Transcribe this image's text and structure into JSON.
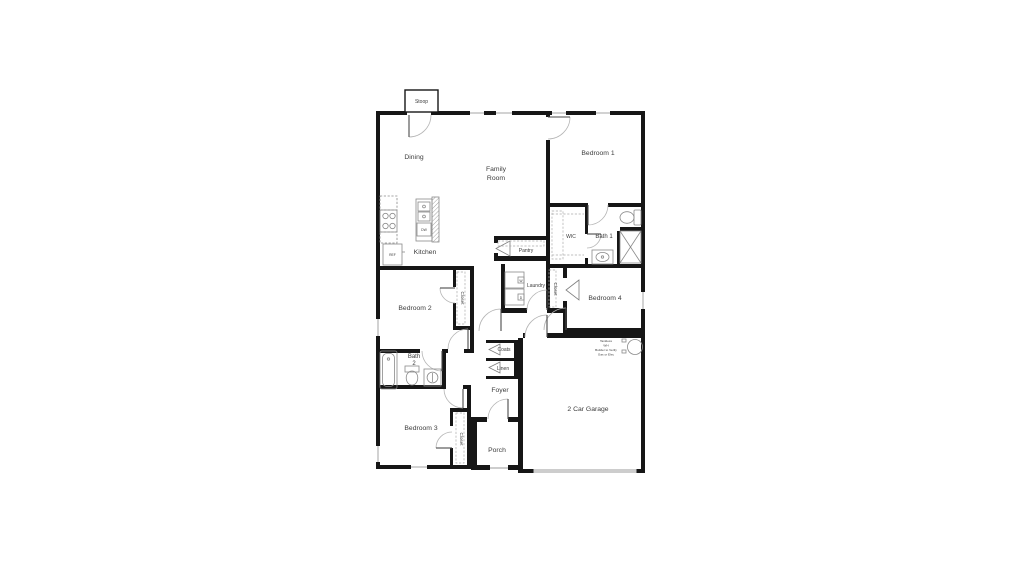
{
  "plan_title": "Single-story residential floor plan",
  "rooms": {
    "stoop": "Stoop",
    "dining": "Dining",
    "family_line1": "Family",
    "family_line2": "Room",
    "bedroom1": "Bedroom 1",
    "kitchen": "Kitchen",
    "wic": "WIC",
    "bath1": "Bath 1",
    "pantry": "Pantry",
    "laundry": "Laundry",
    "bedroom2": "Bedroom 2",
    "bedroom4": "Bedroom 4",
    "closet_bedroom2": "Closet",
    "closet_bedroom3": "Closet",
    "closet_bedroom4": "Closet",
    "coats": "Coats",
    "linen": "Linen",
    "bath2_line1": "Bath",
    "bath2_line2": "2",
    "foyer": "Foyer",
    "bedroom3": "Bedroom 3",
    "porch": "Porch",
    "garage": "2 Car Garage"
  },
  "appliances": {
    "refrigerator": "REF",
    "dishwasher": "DW",
    "washer": "W",
    "dryer": "D"
  },
  "water_heater_note": {
    "line1": "Tankless",
    "line2": "WH",
    "line3": "Builder to Verify",
    "line4": "Gas or Elec"
  },
  "colors": {
    "wall": "#161616",
    "fixture": "#8a8a8a",
    "text": "#3c3c3c",
    "background": "#ffffff"
  }
}
